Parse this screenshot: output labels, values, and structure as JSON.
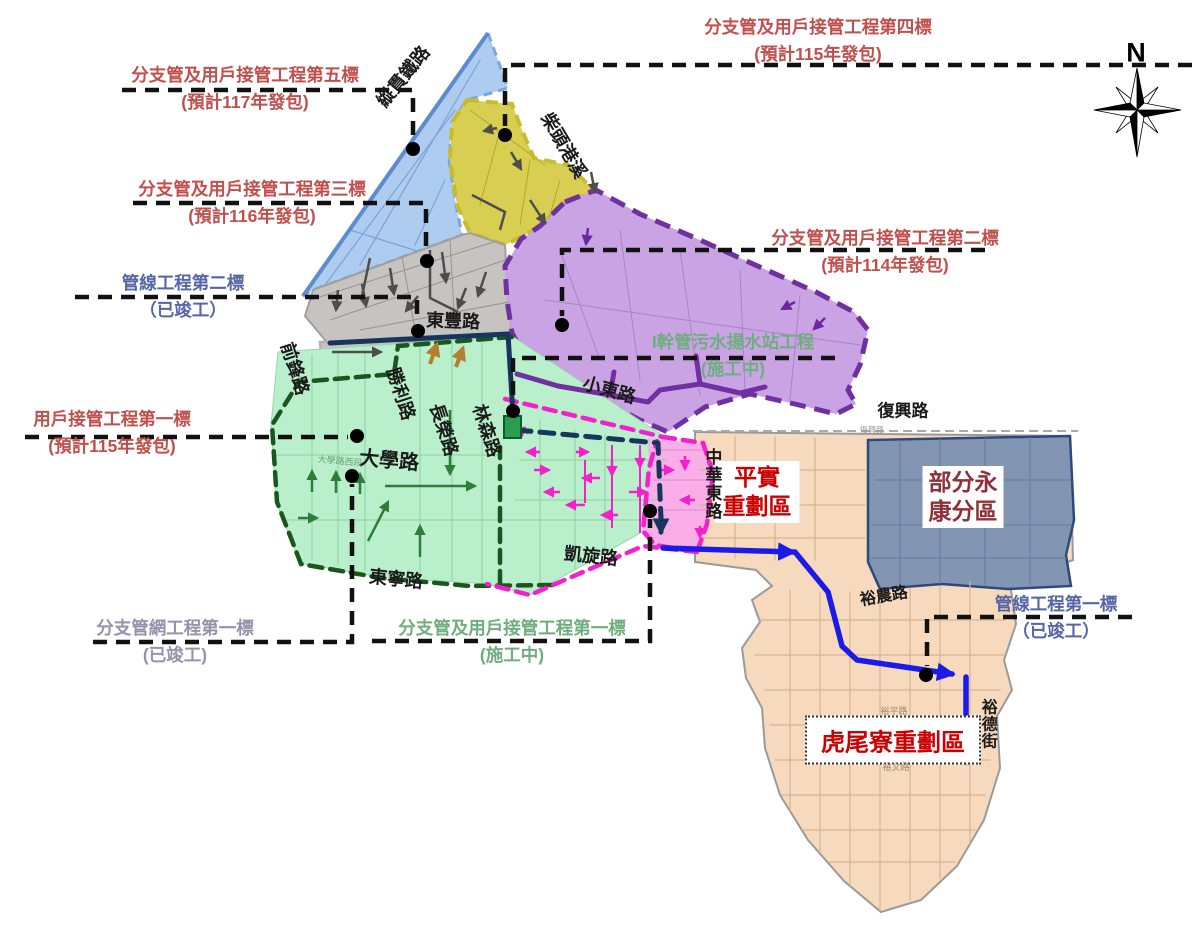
{
  "map": {
    "callouts": {
      "bid4": {
        "title": "分支管及用戶接管工程第四標",
        "subtitle": "(預計115年發包)"
      },
      "bid5": {
        "title": "分支管及用戶接管工程第五標",
        "subtitle": "(預計117年發包)"
      },
      "bid3": {
        "title": "分支管及用戶接管工程第三標",
        "subtitle": "(預計116年發包)"
      },
      "bid2": {
        "title": "分支管及用戶接管工程第二標",
        "subtitle": "(預計114年發包)"
      },
      "pipe2": {
        "title": "管線工程第二標",
        "subtitle": "（已竣工）"
      },
      "pump": {
        "title": "I幹管污水揚水站工程",
        "subtitle": "(施工中)"
      },
      "user1": {
        "title": "用戶接管工程第一標",
        "subtitle": "(預計115年發包)"
      },
      "net1": {
        "title": "分支管網工程第一標",
        "subtitle": "(已竣工)"
      },
      "branch1": {
        "title": "分支管及用戶接管工程第一標",
        "subtitle": "(施工中)"
      },
      "pipe1": {
        "title": "管線工程第一標",
        "subtitle": "（已竣工）"
      }
    },
    "districts": {
      "pingshi": {
        "line1": "平實",
        "line2": "重劃區"
      },
      "yongkang": {
        "line1": "部分永",
        "line2": "康分區"
      },
      "huweiliao": {
        "name": "虎尾寮重劃區"
      }
    },
    "roads": {
      "zongguan": "縱貫鐵路",
      "chaitou": "柴頭港溪",
      "dongfeng": "東豐路",
      "qianfeng": "前鋒路",
      "shengli": "勝利路",
      "changrong": "長榮路",
      "linsen": "林森路",
      "xiaodong": "小東路",
      "daxue": "大學路",
      "daxuewest": "大學路西段",
      "dongning": "東寧路",
      "kaixuan": "凱旋路",
      "zhonghua": "中華東路",
      "fuxing": "復興路",
      "fuxing_sm": "復興路",
      "yunong": "裕農路",
      "yude": "裕德街",
      "yuping": "裕平路",
      "yuwen": "裕文路"
    },
    "compass": {
      "north": "N"
    },
    "colors": {
      "zone-blue": "#aecbf0",
      "zone-yellow": "#d7ce52",
      "zone-gray": "#c6c3c0",
      "zone-purple": "#c9a3e3",
      "zone-green": "#baefcc",
      "zone-pink": "#f9aee8",
      "zone-peach": "#f7dabd",
      "zone-slate": "#8296b4",
      "border-blue": "#79a7dd",
      "border-yellow": "#c8bb2e",
      "border-purple": "#7030a0",
      "border-green": "#1a571f",
      "magenta": "#f320cc",
      "navy": "#17365d",
      "route-blue": "#1b1be8",
      "leader-black": "#111111",
      "label-red": "#c0504d",
      "label-blue": "#5565a5",
      "label-green": "#6fae7e",
      "label-gray": "#9393ab",
      "district-red": "#cc0000",
      "district-maroon": "#8f3038",
      "road-black": "#1a1a1a",
      "arrow-gray": "#4d4d4d",
      "arrow-green": "#2f7d3a",
      "arrow-tan": "#b08030",
      "arrow-purple": "#6a28a0"
    }
  }
}
